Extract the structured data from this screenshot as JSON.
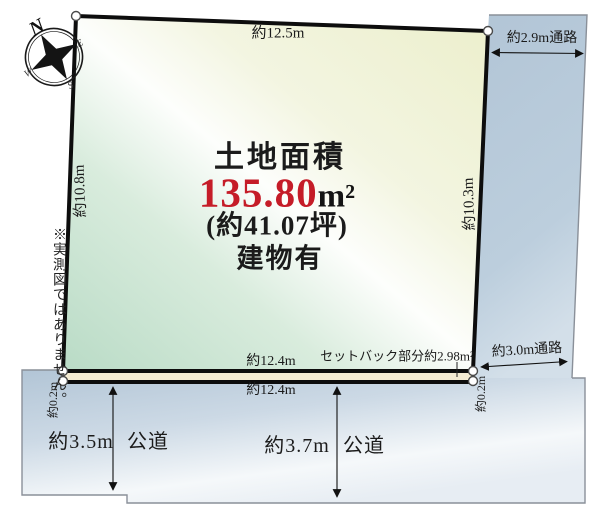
{
  "colors": {
    "accent_red": "#c51c28",
    "plot_green": "#bedeca",
    "plot_yellow": "#eef0d2",
    "road_blue": "#b6c9d8",
    "setback_cream": "#f4ebd2",
    "border_black": "#0d0d0d"
  },
  "compass": {
    "n": "N",
    "e": "E",
    "s": "S",
    "w": "W"
  },
  "note": "※実測図ではありません。",
  "land": {
    "title": "土地面積",
    "area": "135.80",
    "unit": "m²",
    "tsubo": "(約41.07坪)",
    "building": "建物有"
  },
  "dims": {
    "top": "約12.5m",
    "left": "約10.8m",
    "right": "約10.3m",
    "bottom_inner": "約12.4m",
    "bottom_outer": "約12.4m",
    "corner_left": "約0.2m",
    "corner_right": "約0.2m",
    "setback": "セットバック部分約2.98m²"
  },
  "passages": {
    "top": "約2.9m通路",
    "right": "約3.0m通路"
  },
  "roads": {
    "left_width": "約3.5m",
    "left_type": "公道",
    "right_width": "約3.7m",
    "right_type": "公道"
  }
}
